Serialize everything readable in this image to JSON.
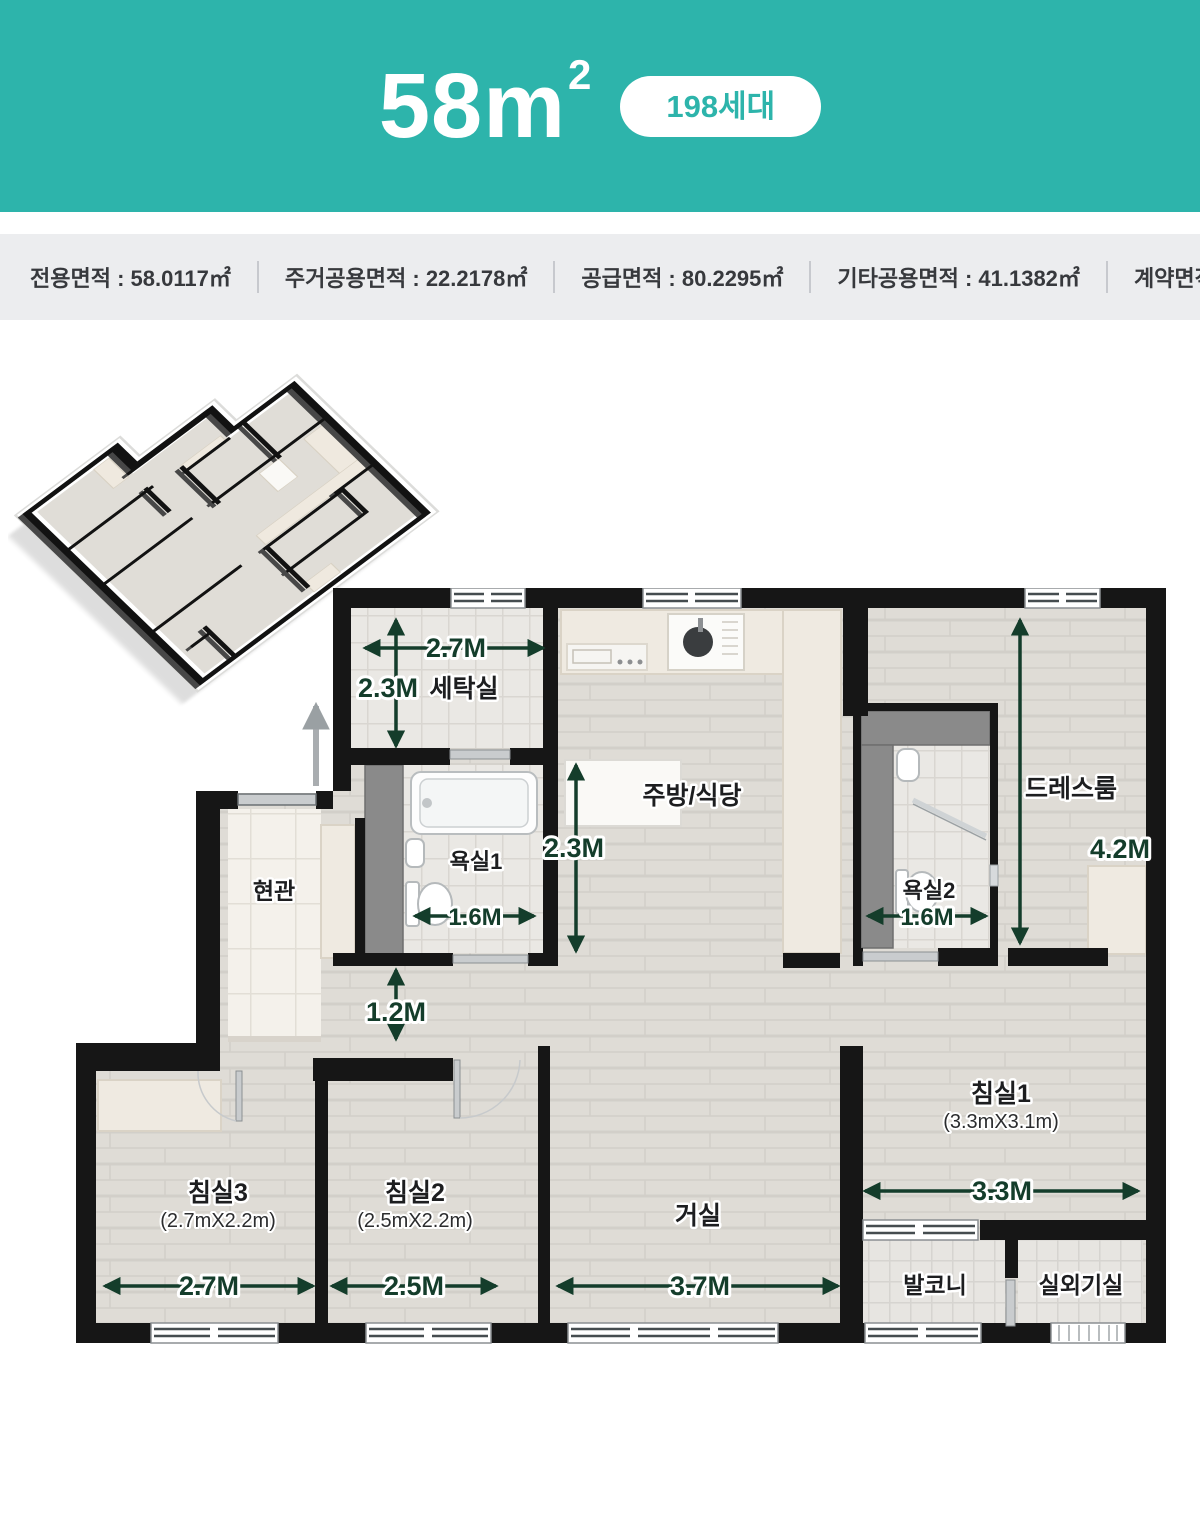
{
  "header": {
    "size": "58m",
    "size_sup": "2",
    "badge": "198세대"
  },
  "info_bar": {
    "items": [
      "전용면적 : 58.0117㎡",
      "주거공용면적 : 22.2178㎡",
      "공급면적 : 80.2295㎡",
      "기타공용면적 : 41.1382㎡",
      "계약면적 : 121.3677㎡"
    ]
  },
  "rooms": {
    "laundry": "세탁실",
    "bath1": "욕실1",
    "bath2": "욕실2",
    "kitchen": "주방/식당",
    "dressroom": "드레스룸",
    "entrance": "현관",
    "living": "거실",
    "bed1": "침실1",
    "bed1_size": "(3.3mX3.1m)",
    "bed2": "침실2",
    "bed2_size": "(2.5mX2.2m)",
    "bed3": "침실3",
    "bed3_size": "(2.7mX2.2m)",
    "balcony": "발코니",
    "ac_room": "실외기실"
  },
  "dims": {
    "laundry_w": "2.7M",
    "laundry_h": "2.3M",
    "kitchen_h": "2.3M",
    "bath1_w": "1.6M",
    "bath2_w": "1.6M",
    "dress_h": "4.2M",
    "hall_w": "1.2M",
    "bed3_w": "2.7M",
    "bed2_w": "2.5M",
    "living_w": "3.7M",
    "bed1_w": "3.3M"
  },
  "colors": {
    "accent": "#2DB4AB",
    "arrow": "#143D2B",
    "wall": "#161616",
    "info_bg": "#ECEDEF"
  }
}
